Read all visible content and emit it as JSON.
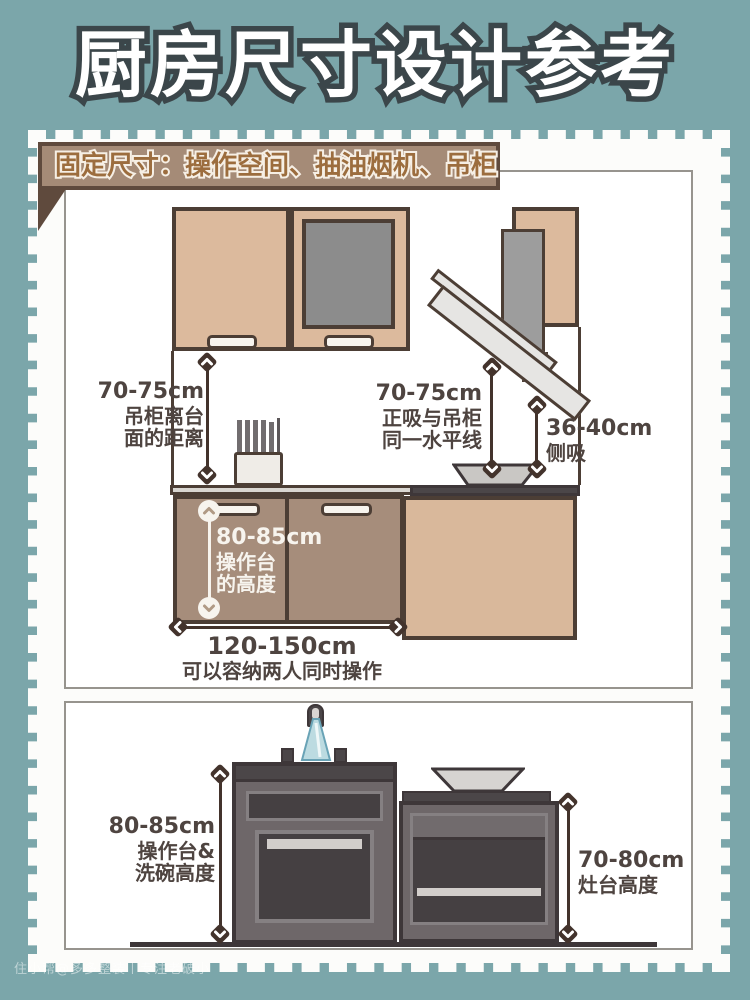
{
  "title": "厨房尺寸设计参考",
  "watermark": "住小帮@多多整装丨专注老破小",
  "colors": {
    "background_teal": "#7ba6aa",
    "title_fill": "#ffffff",
    "title_outline": "#3b464a",
    "card_white": "#fcfcfa",
    "banner_bg": "#a58b77",
    "banner_border": "#5f4a3d",
    "banner_text": "#9c6d3e",
    "cabinet_tan": "#dcba9d",
    "cabinet_border": "#4c3e35",
    "base_cabinet_taupe": "#a68d7b",
    "stove_cabinet_tan": "#d9b89b",
    "glass_gray": "#8c8c8c",
    "hood_gray": "#e6e5e3",
    "appliance_gray": "#6e6769",
    "appliance_dark": "#454042",
    "label_text": "#4e4440",
    "arrow_dark": "#43332c",
    "water_blue": "#bcdbe1"
  },
  "section_fixed": {
    "banner": "固定尺寸：操作空间、抽油烟机、吊柜",
    "hang_gap": {
      "value": "70-75cm",
      "line1": "吊柜离台",
      "line2": "面的距离"
    },
    "hood_gap": {
      "value": "70-75cm",
      "line1": "正吸与吊柜",
      "line2": "同一水平线"
    },
    "side_hood": {
      "value": "36-40cm",
      "line1": "侧吸"
    },
    "counter_height": {
      "value": "80-85cm",
      "line1": "操作台",
      "line2": "的高度"
    },
    "counter_width": {
      "value": "120-150cm",
      "note": "可以容纳两人同时操作"
    }
  },
  "section_heights": {
    "sink_height": {
      "value": "80-85cm",
      "line1": "操作台&",
      "line2": "洗碗高度"
    },
    "stove_height": {
      "value": "70-80cm",
      "line1": "灶台高度"
    }
  }
}
